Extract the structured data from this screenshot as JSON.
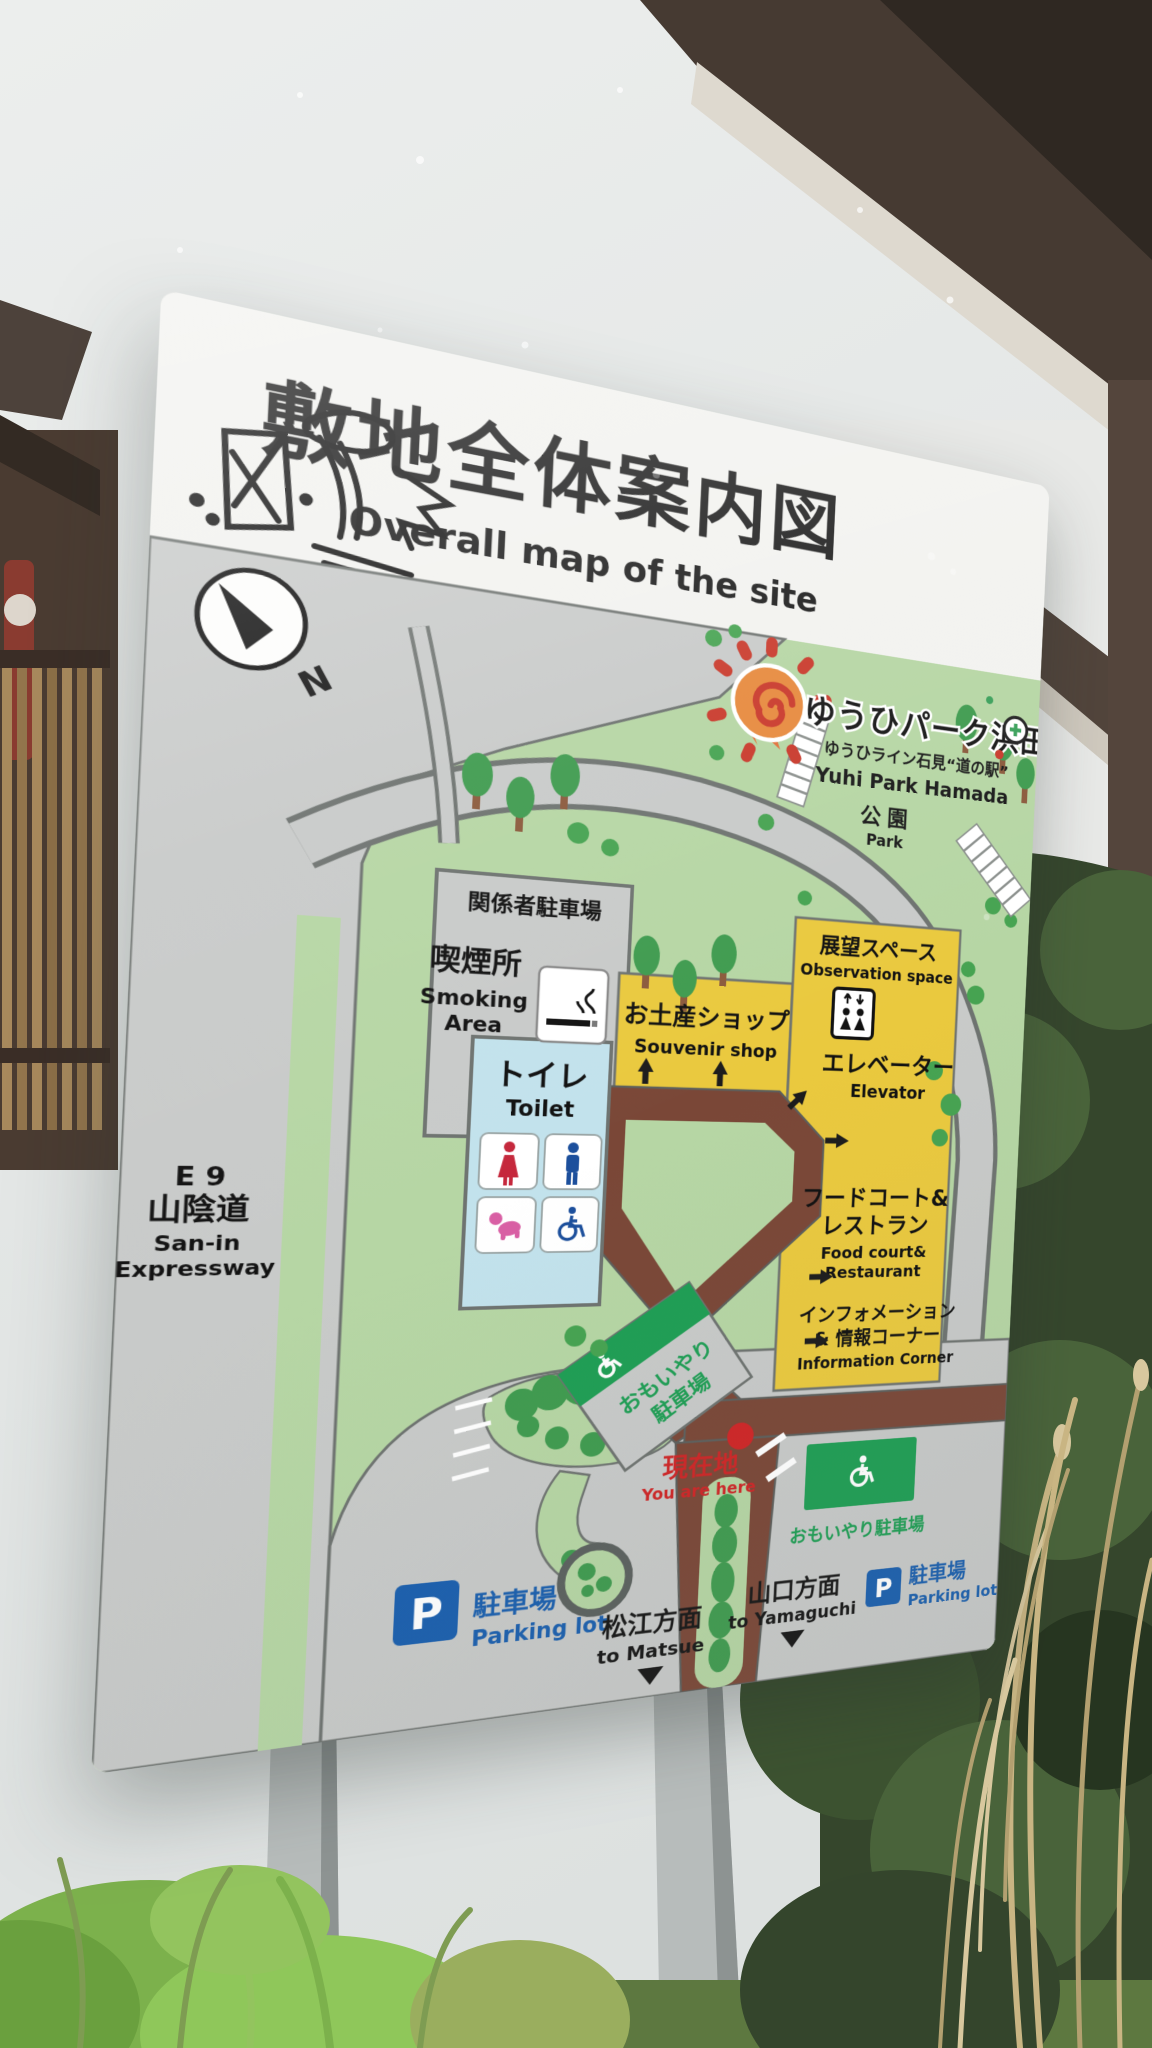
{
  "sign": {
    "title_jp": "敷地全体案内図",
    "title_en": "Overall map of the site",
    "compass_n": "N",
    "logo": {
      "name_jp": "ゆうひパーク浜田",
      "line_jp": "ゆうひライン石見“道の駅”",
      "name_en": "Yuhi Park Hamada"
    },
    "park": {
      "jp": "公園",
      "en": "Park"
    },
    "staff_parking": {
      "jp": "関係者駐車場"
    },
    "smoking": {
      "jp": "喫煙所",
      "en1": "Smoking",
      "en2": "Area"
    },
    "toilet": {
      "jp": "トイレ",
      "en": "Toilet"
    },
    "souvenir": {
      "jp": "お土産ショップ",
      "en": "Souvenir shop"
    },
    "elevator": {
      "jp": "エレベーター",
      "en": "Elevator"
    },
    "observation": {
      "jp": "展望スペース",
      "en": "Observation space"
    },
    "food": {
      "jp1": "フードコート&",
      "jp2": "レストラン",
      "en1": "Food court&",
      "en2": "Restaurant"
    },
    "info": {
      "jp1": "インフォメーション",
      "jp2": "& 情報コーナー",
      "en": "Information Corner"
    },
    "priority_parking_tilted": {
      "jp1": "おもいやり",
      "jp2": "駐車場"
    },
    "priority_parking_right": {
      "jp": "おもいやり駐車場"
    },
    "you_are_here": {
      "jp": "現在地",
      "en": "You are here"
    },
    "expressway": {
      "code": "E 9",
      "jp": "山陰道",
      "en1": "San-in",
      "en2": "Expressway"
    },
    "parking_left": {
      "p": "P",
      "jp": "駐車場",
      "en": "Parking lot"
    },
    "parking_right": {
      "p": "P",
      "jp": "駐車場",
      "en": "Parking lot"
    },
    "to_matsue": {
      "jp": "松江方面",
      "en": "to Matsue"
    },
    "to_yamaguchi": {
      "jp": "山口方面",
      "en": "to Yamaguchi"
    },
    "colors": {
      "building_yellow": "#eac93e",
      "road_gray": "#c8cac9",
      "park_green": "#b6d6a4",
      "walkway_brown": "#7a4737",
      "priority_green": "#1e9e54",
      "toilet_blue": "#c2e2ec",
      "parking_blue": "#1a5fae",
      "here_red": "#cf2526"
    }
  }
}
